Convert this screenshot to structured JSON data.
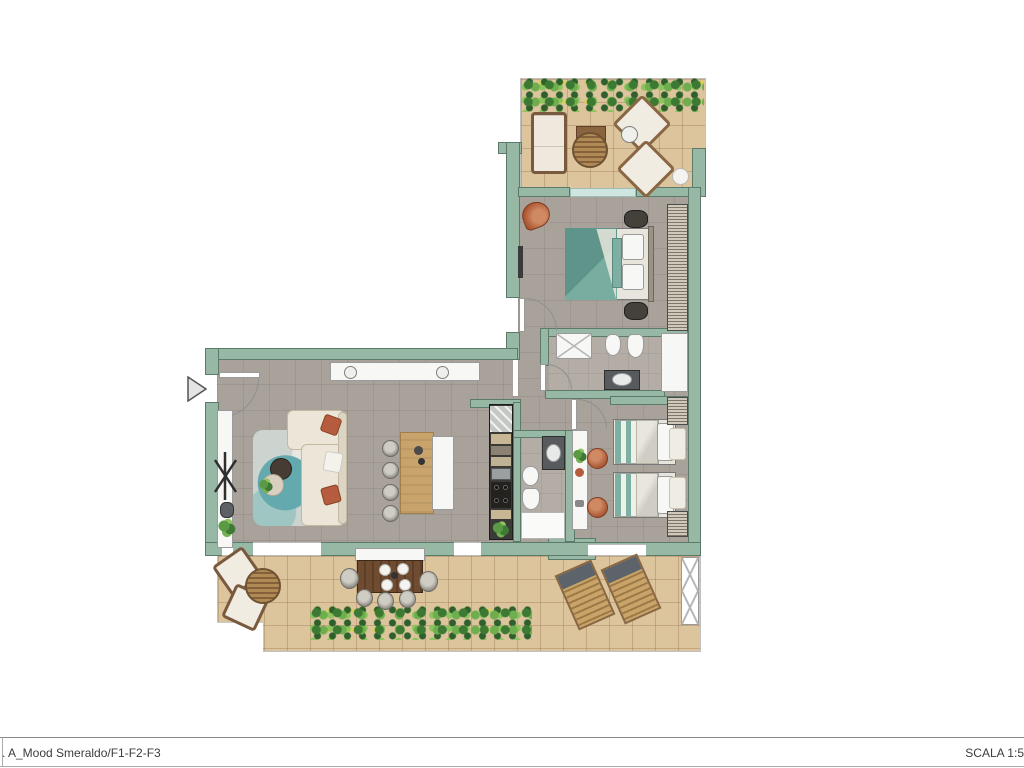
{
  "footer": {
    "left_label": ". A_Mood Smeraldo/F1-F2-F3",
    "right_label": "SCALA 1:5"
  },
  "palette": {
    "wall": "#96b8a5",
    "wall_outline": "#5c7a6a",
    "floor_int": "#a9a29b",
    "floor_ter": "#dcc49c",
    "teal": "#6fa79a",
    "terracotta": "#b65c3e",
    "wood": "#c8a36b",
    "counter": "#3b3a36",
    "white_fix": "#f7f7f5"
  },
  "plan": {
    "type": "apartment floor plan, L-shaped, top-down render",
    "rooms": [
      {
        "name": "upper-terrace",
        "furniture": [
          "outdoor sofa",
          "square side table",
          "round rattan table",
          "two angled lounge chairs",
          "planter hedge along top edge",
          "decorative sphere"
        ]
      },
      {
        "name": "master-bedroom",
        "furniture": [
          "double bed with teal duvet",
          "two dark nightstands",
          "full-height wardrobe on right wall",
          "terracotta armchair",
          "sliding glass door to terrace"
        ]
      },
      {
        "name": "bathroom-1",
        "furniture": [
          "shower",
          "bidet",
          "toilet",
          "dark vanity with basin",
          "white closet"
        ]
      },
      {
        "name": "living-dining-room",
        "furniture": [
          "L-shaped cream sofa with rust pillows",
          "patterned rug",
          "dark round coffee table",
          "light round side table with plant",
          "wood dining table",
          "four grey chairs",
          "white bench",
          "white sideboard with two bowls",
          "tall white cabinet",
          "coat stand",
          "floor plant"
        ]
      },
      {
        "name": "kitchen",
        "furniture": [
          "linear dark counter",
          "sink",
          "four-burner hob",
          "cabinets",
          "plant"
        ]
      },
      {
        "name": "bathroom-2",
        "furniture": [
          "dark vanity with basin",
          "bidet",
          "toilet",
          "shower"
        ]
      },
      {
        "name": "twin-bedroom",
        "furniture": [
          "two single beds with striped teal bedding",
          "white desk strip with plant",
          "two terracotta poufs",
          "hatched nightstands",
          "headboard cushions"
        ]
      },
      {
        "name": "lower-terrace",
        "furniture": [
          "two angled armchairs",
          "round rattan table",
          "dark outdoor dining table with plates",
          "six round chairs",
          "white bench",
          "two wooden sun loungers",
          "X trellis panel",
          "hedge along bottom"
        ]
      }
    ],
    "entrance": "left wall of living room, marked with grey triangle arrow"
  }
}
